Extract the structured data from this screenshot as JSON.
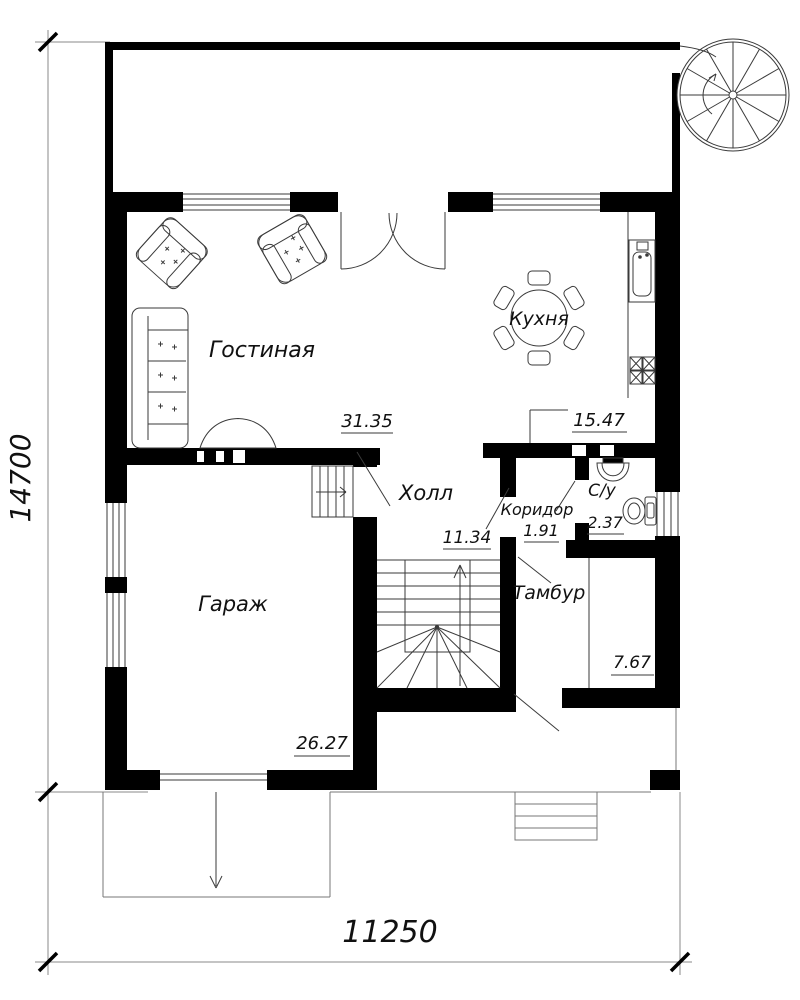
{
  "drawing": {
    "type": "first-floor-plan"
  },
  "rooms": {
    "living": {
      "label": "Гостиная",
      "area": "31.35"
    },
    "kitchen": {
      "label": "Кухня",
      "area": "15.47"
    },
    "hall": {
      "label": "Холл",
      "area": "11.34"
    },
    "corridor": {
      "label": "Коридор",
      "area": "1.91"
    },
    "bathroom": {
      "label": "С/у",
      "area": "2.37"
    },
    "vestibule": {
      "label": "Тамбур",
      "area": "7.67"
    },
    "garage": {
      "label": "Гараж",
      "area": "26.27"
    }
  },
  "dimensions": {
    "height": "14700",
    "width": "11250"
  },
  "colors": {
    "wall": "#000000",
    "line": "#3a3a3a",
    "background": "#ffffff"
  }
}
